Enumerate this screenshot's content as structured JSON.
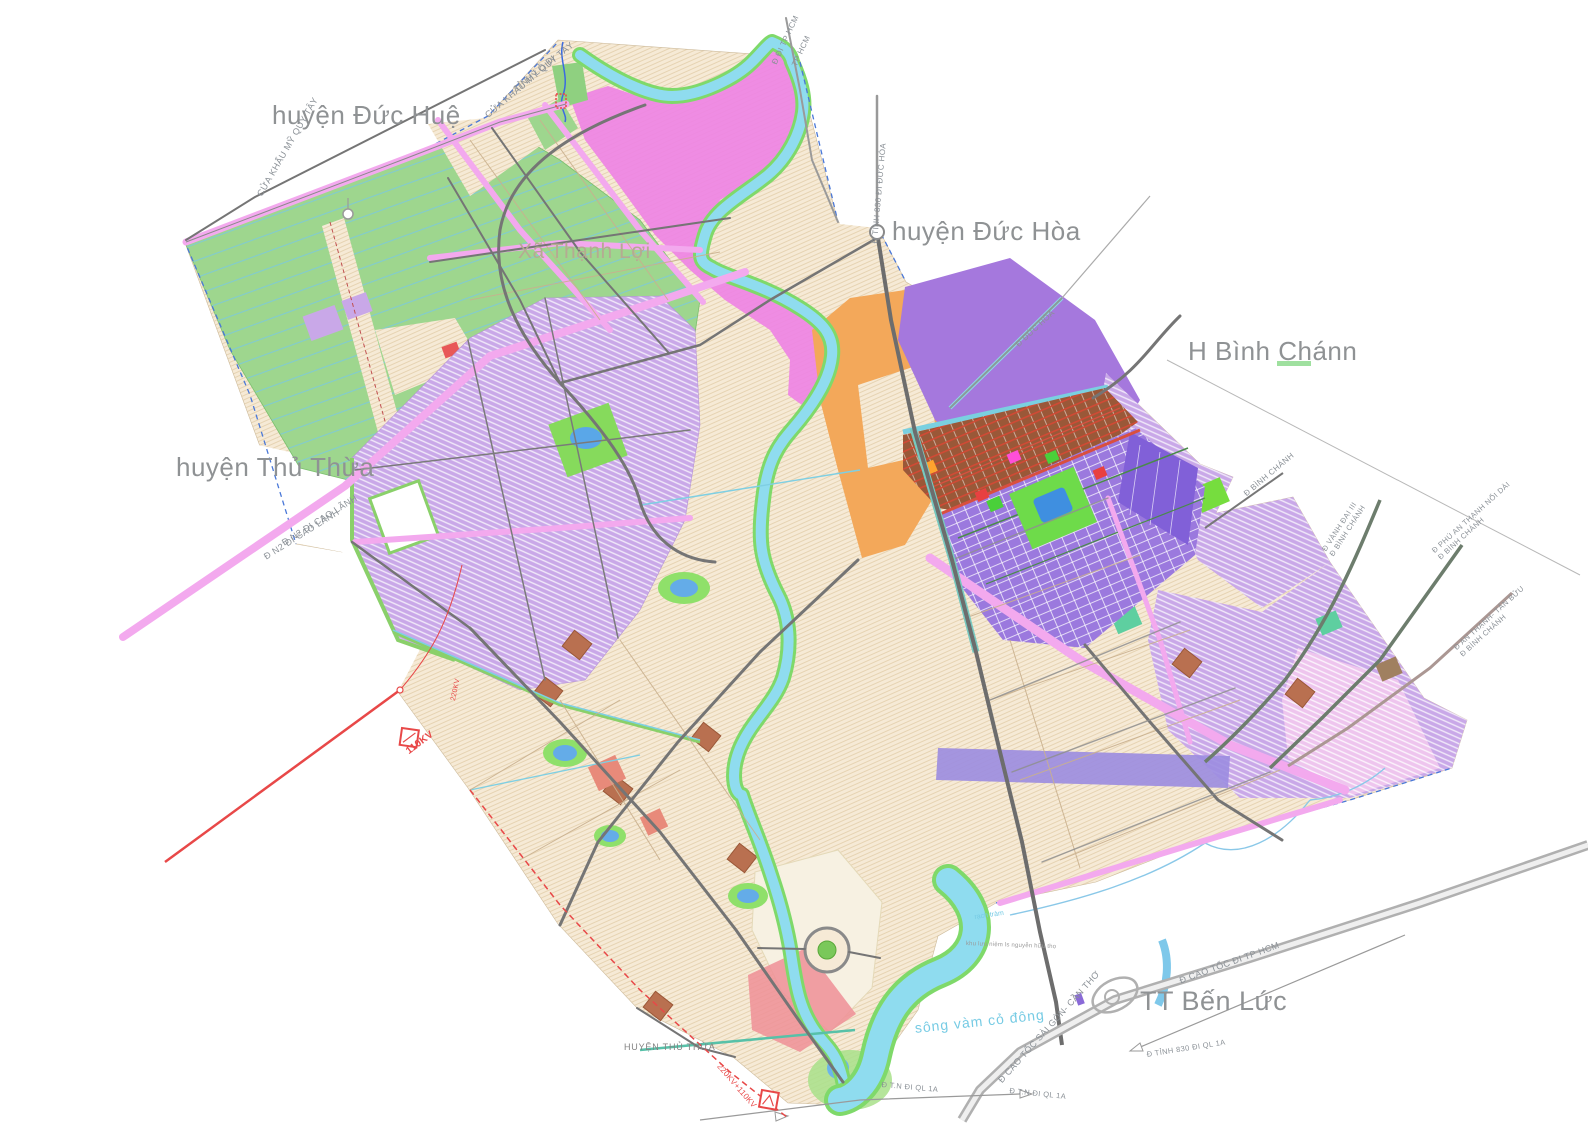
{
  "map_title": "Quy hoạch huyện Bến Lức",
  "labels": {
    "region": {
      "duc_hue": "huyện Đức Huệ",
      "duc_hoa": "huyện  Đức Hòa",
      "binh_chanh": "H Bình Chánn",
      "thu_thua": "huyện Thủ Thừa",
      "ben_luc": "TT Bến Lức",
      "xa": "Xã Thạnh Lợi",
      "thu_thua_small": "HUYỆN THỦ THỪA"
    },
    "road": {
      "tinh_lo": "TỈNH LỘ ĐI",
      "cua_khau_a": "CỬA KHẨU MỸ QUY TÂY",
      "cua_khau_b": "CỬA KHẨU MỸ QUY TÂY",
      "di_tphcm": "Đ ĐI TP HCM",
      "tphcm": "TP HCM",
      "dt830_dh": "Đ TỈNH 830 ĐI ĐỨC HÒA",
      "duc_hoa_rd": "Đ ĐỨC HÒA",
      "binh_chanh_rd": "Đ BÌNH CHÁNH",
      "vd3_1": "Đ VÀNH ĐAI III",
      "vd3_2": "Đ BÌNH CHÁNH",
      "pat_1": "Đ PHÚ AN THẠNH NỐI DÀI",
      "pat_2": "Đ BÌNH CHÁNH",
      "atb_1": "Đ AN THẠNH- TÂN BỬU",
      "atb_2": "Đ BÌNH CHÁNH",
      "n2a": "Đ N2 ĐI CAO LÃNH",
      "n2b": "Đ N2 ĐI CAO LÃNH",
      "ct_hcm": "Đ CAO TỐC ĐI TP HCM",
      "ct_sgct": "Đ CAO TỐC SÀI GÒN- CẦN THƠ",
      "dt830_ql": "Đ TỈNH 830 ĐI QL 1A",
      "tn_a": "Đ T.N ĐI QL 1A",
      "tn_b": "Đ T.N ĐI QL 1A"
    },
    "water": {
      "song_a": "sông vàm cỏ đông",
      "rach": "rạch tràm"
    },
    "power": {
      "kv110": "110KV",
      "kv220": "220KV",
      "kv220110": "220KV+110KV"
    },
    "poi": {
      "memorial": "khu lưu niệm ls nguyễn hữu thọ"
    }
  },
  "colors": {
    "beige": "#f6ead6",
    "lavender": "#c9a8e8",
    "magenta": "#ee82e4",
    "pink_road": "#f3a9ee",
    "green_agri": "#9ed68e",
    "river": "#8fdcef",
    "river_bank": "#7fd96a",
    "purple": "#a578dd",
    "purple_grid": "#9b79de",
    "indigo": "#8160d8",
    "orange": "#f3a85a",
    "brown": "#9a5838",
    "red_power": "#e84848",
    "road_dark": "#6d6d6d",
    "road_light": "#9a9a9a",
    "highway": "#b0b0b0",
    "lake": "#4a97e4",
    "label_gray": "#8f9294",
    "label_water": "#76cbe4"
  }
}
